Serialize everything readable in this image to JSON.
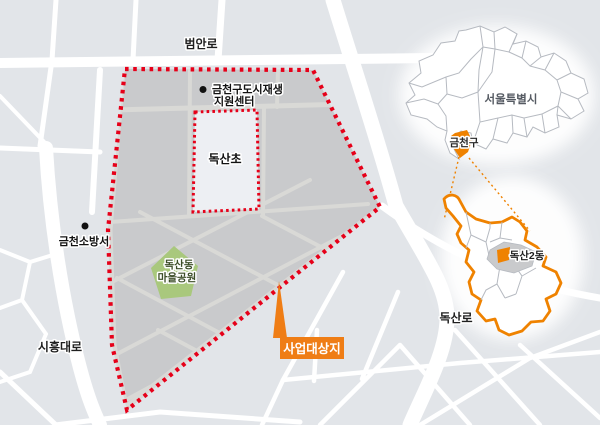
{
  "main_map": {
    "road_labels": {
      "beomanro": "범안로",
      "siheungdaero": "시흥대로",
      "doksanro": "독산로"
    },
    "facilities": {
      "support_center_line1": "금천구도시재생",
      "support_center_line2": "지원센터",
      "fire_station": "금천소방서",
      "school": "독산초",
      "park_line1": "독산동",
      "park_line2": "마을공원"
    },
    "project_site_label": "사업대상지"
  },
  "inset_seoul": {
    "city_label": "서울특별시",
    "district_label": "금천구"
  },
  "inset_gumcheon": {
    "dong_label": "독산2동"
  },
  "colors": {
    "background": "#e2e5e9",
    "road_white": "#ffffff",
    "project_area_fill": "#c9cacc",
    "project_inner_road": "#d9d9d6",
    "boundary_red": "#e60019",
    "park_green": "#a9c87d",
    "accent_orange": "#ef8200",
    "callout_orange": "#ef7d15",
    "school_block": "#edeff3"
  }
}
